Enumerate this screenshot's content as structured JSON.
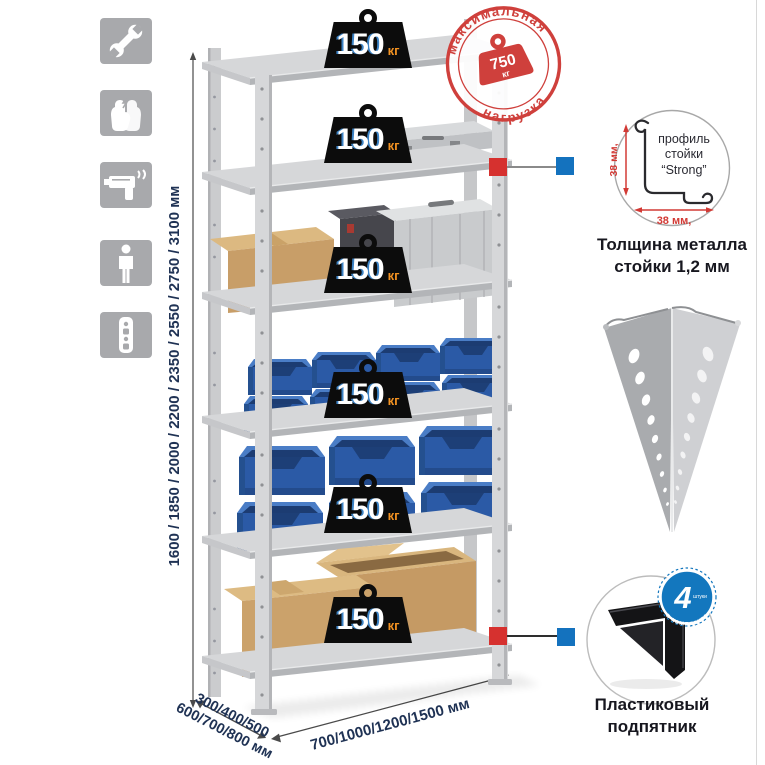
{
  "stamp": {
    "arc_top": "максимальная",
    "arc_bottom": "нагрузка",
    "weight_value": "750",
    "weight_unit": "кг"
  },
  "shelves": [
    {
      "load_value": "150",
      "load_unit": "кг"
    },
    {
      "load_value": "150",
      "load_unit": "кг"
    },
    {
      "load_value": "150",
      "load_unit": "кг"
    },
    {
      "load_value": "150",
      "load_unit": "кг"
    },
    {
      "load_value": "150",
      "load_unit": "кг"
    },
    {
      "load_value": "150",
      "load_unit": "кг"
    }
  ],
  "dimensions": {
    "height": "1600 / 1850 / 2000 / 2200 / 2350 / 2550 / 2750 / 3100 мм",
    "depth_line1": "300/400/500",
    "depth_line2": "600/700/800 мм",
    "width": "700/1000/1200/1500 мм"
  },
  "profile_callout": {
    "label_line1": "профиль",
    "label_line2": "стойки",
    "label_line3": "“Strong”",
    "dim_vertical": "38 мм,",
    "dim_horizontal": "38 мм,",
    "caption_line1": "Толщина металла",
    "caption_line2": "стойки 1,2 мм"
  },
  "foot_callout": {
    "badge_count": "4",
    "badge_units": "штуки",
    "badge_arc": "в комплекте",
    "caption_line1": "Пластиковый",
    "caption_line2": "подпятник"
  },
  "icons": [
    {
      "name": "wrench"
    },
    {
      "name": "gloves"
    },
    {
      "name": "drill"
    },
    {
      "name": "person"
    },
    {
      "name": "rack-post"
    }
  ],
  "colors": {
    "accent_red": "#cf403c",
    "accent_blue": "#1377be",
    "badge_black": "#0c0c0c",
    "unit_orange": "#f29222",
    "bin_blue": "#2e5fae",
    "metal_gray": "#d6d7d9",
    "label_navy": "#1f3254"
  }
}
